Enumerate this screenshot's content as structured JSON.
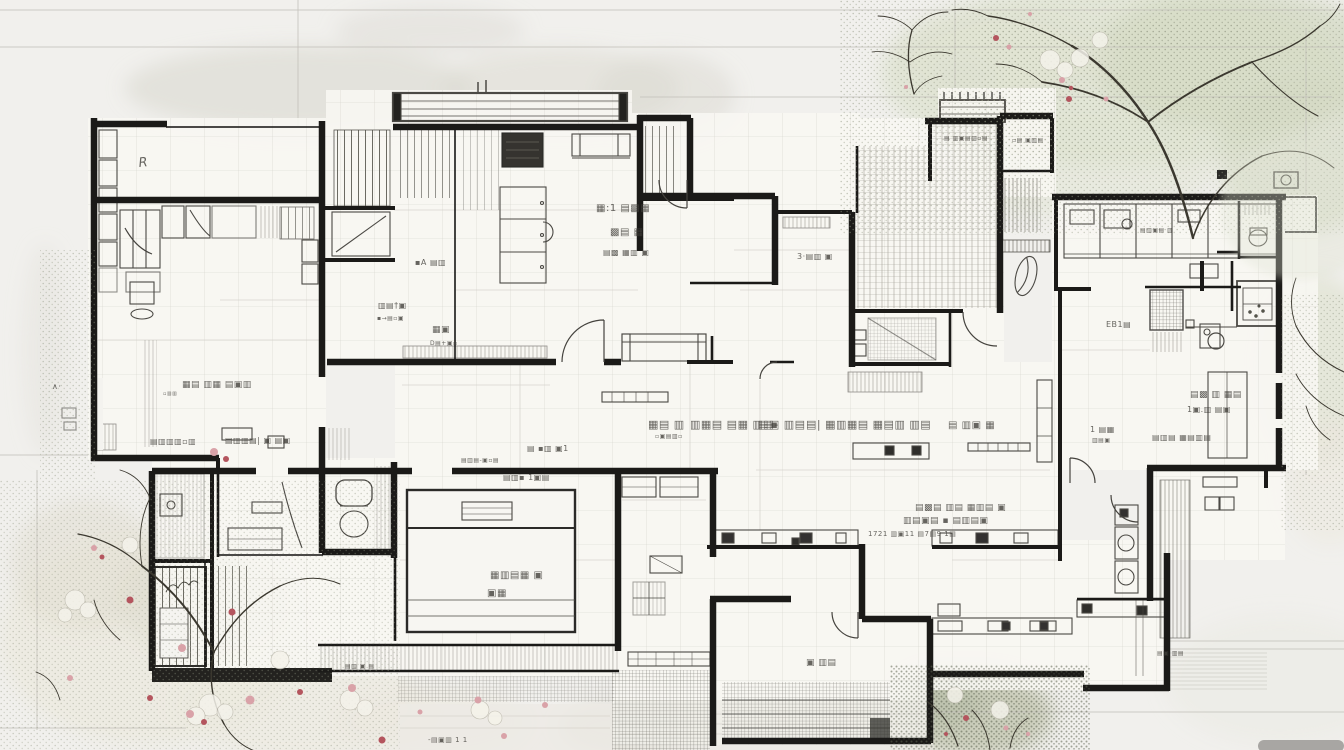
{
  "meta": {
    "description": "Hand-sketched architectural floor plan with cherry-blossom trees and garden, annotated with illegible handwritten room labels"
  },
  "palette": {
    "paper": "#f1f0ed",
    "wall": "#1b1a18",
    "line": "#4b4944",
    "grid": "#cfcdc6",
    "text": "#413f3a",
    "floor": "#f8f7f3",
    "table_fill": "#f7f6f2",
    "stove": "#35332f",
    "band_dark": "#23221f",
    "wash_gray": "#dcdad2",
    "wash_green": "#dfe3d2",
    "wash_green2": "#d3d8c3",
    "wash_pale": "#eceadf",
    "bush_dark": "#b9bfa9",
    "branch": "#3b382f",
    "blossom_pink": "#d9a2a8",
    "blossom_red": "#b4555e",
    "ground": "#e7e5de",
    "blob": "#a8a6a3"
  },
  "annotations": [
    {
      "x": 139,
      "y": 167,
      "size": 13,
      "text": "R",
      "italic": true,
      "rotate": -6
    },
    {
      "x": 182,
      "y": 387,
      "size": 9,
      "text": "▦▤ ▥▦ ▤▣▥"
    },
    {
      "x": 163,
      "y": 395,
      "size": 5,
      "text": "▫▥▥"
    },
    {
      "x": 150,
      "y": 444,
      "size": 8,
      "text": "▤▥▥▥▫▥"
    },
    {
      "x": 225,
      "y": 443,
      "size": 8,
      "text": "▤▥▥▤| ▣ ▤▣"
    },
    {
      "x": 415,
      "y": 265,
      "size": 8,
      "text": "▪A ▤▥"
    },
    {
      "x": 378,
      "y": 308,
      "size": 8,
      "text": "▥▤†▣"
    },
    {
      "x": 377,
      "y": 320,
      "size": 6,
      "text": "▪→▤▫▣"
    },
    {
      "x": 432,
      "y": 332,
      "size": 9,
      "text": "▦▣"
    },
    {
      "x": 430,
      "y": 345,
      "size": 6,
      "text": "D▤+▣▫"
    },
    {
      "x": 596,
      "y": 211,
      "size": 10,
      "text": "▦:1 ▤▩▦"
    },
    {
      "x": 610,
      "y": 235,
      "size": 10,
      "text": "▩▤ ▦"
    },
    {
      "x": 603,
      "y": 255,
      "size": 8,
      "text": "▤▩ ▦▥ ▣"
    },
    {
      "x": 797,
      "y": 259,
      "size": 8,
      "text": "3·▤▥ ▣"
    },
    {
      "x": 527,
      "y": 451,
      "size": 8,
      "text": "▤ ▪▥ ▣1"
    },
    {
      "x": 461,
      "y": 462,
      "size": 6,
      "text": "▤▥▤-▣▫▤"
    },
    {
      "x": 503,
      "y": 480,
      "size": 8,
      "text": "▤▥▪ 1▣▤"
    },
    {
      "x": 490,
      "y": 578,
      "size": 10,
      "text": "▦▥▤▦ ▣"
    },
    {
      "x": 487,
      "y": 596,
      "size": 10,
      "text": "▣▦"
    },
    {
      "x": 648,
      "y": 428,
      "size": 11,
      "text": "▦▤ ▥"
    },
    {
      "x": 655,
      "y": 438,
      "size": 6,
      "text": "▫▣▤▥▫"
    },
    {
      "x": 690,
      "y": 428,
      "size": 11,
      "text": "▥▦▤ ▤▦ ▥▤-"
    },
    {
      "x": 758,
      "y": 428,
      "size": 11,
      "text": "▤▣ ▥▤"
    },
    {
      "x": 806,
      "y": 428,
      "size": 11,
      "text": "▤| ▦▥▦▤ ▦▤▥ ▥▤"
    },
    {
      "x": 948,
      "y": 428,
      "size": 10,
      "text": "▤ ▥▣ ▦"
    },
    {
      "x": 1090,
      "y": 432,
      "size": 8,
      "text": "1 ▤▦"
    },
    {
      "x": 1092,
      "y": 442,
      "size": 6,
      "text": "▥▤▣"
    },
    {
      "x": 1152,
      "y": 440,
      "size": 8,
      "text": "▤▥▤ ▦▤▥▤"
    },
    {
      "x": 915,
      "y": 510,
      "size": 9,
      "text": "▤▩▤ ▥▤ ▦▥▤ ▣"
    },
    {
      "x": 903,
      "y": 523,
      "size": 9,
      "text": "▥▤▣▤ ▪ ▤▥▤▣"
    },
    {
      "x": 868,
      "y": 536,
      "size": 7,
      "text": "1721 ▥▣11 ▤7▤9 1▤"
    },
    {
      "x": 1190,
      "y": 397,
      "size": 9,
      "text": "▤▩ ▥ ▦▤"
    },
    {
      "x": 1187,
      "y": 412,
      "size": 8,
      "text": "1▣.▥ ▤▣"
    },
    {
      "x": 1106,
      "y": 327,
      "size": 8,
      "text": "EB1▤"
    },
    {
      "x": 1140,
      "y": 232,
      "size": 6,
      "text": "▤▥▣▤ ▥"
    },
    {
      "x": 806,
      "y": 665,
      "size": 9,
      "text": "▣ ▥▤"
    },
    {
      "x": 428,
      "y": 742,
      "size": 7,
      "text": "-▤▣▥ 1 1"
    },
    {
      "x": 345,
      "y": 668,
      "size": 6,
      "text": "▤▥ ▣ ▤"
    },
    {
      "x": 944,
      "y": 140,
      "size": 6,
      "text": "▤ ▥▣▤▥▫▤"
    },
    {
      "x": 1012,
      "y": 142,
      "size": 6,
      "text": "▫▤ ▣▥▤"
    },
    {
      "x": 52,
      "y": 389,
      "size": 8,
      "text": "∧·"
    },
    {
      "x": 1157,
      "y": 655,
      "size": 6,
      "text": "▤▣ ▥▤"
    }
  ]
}
